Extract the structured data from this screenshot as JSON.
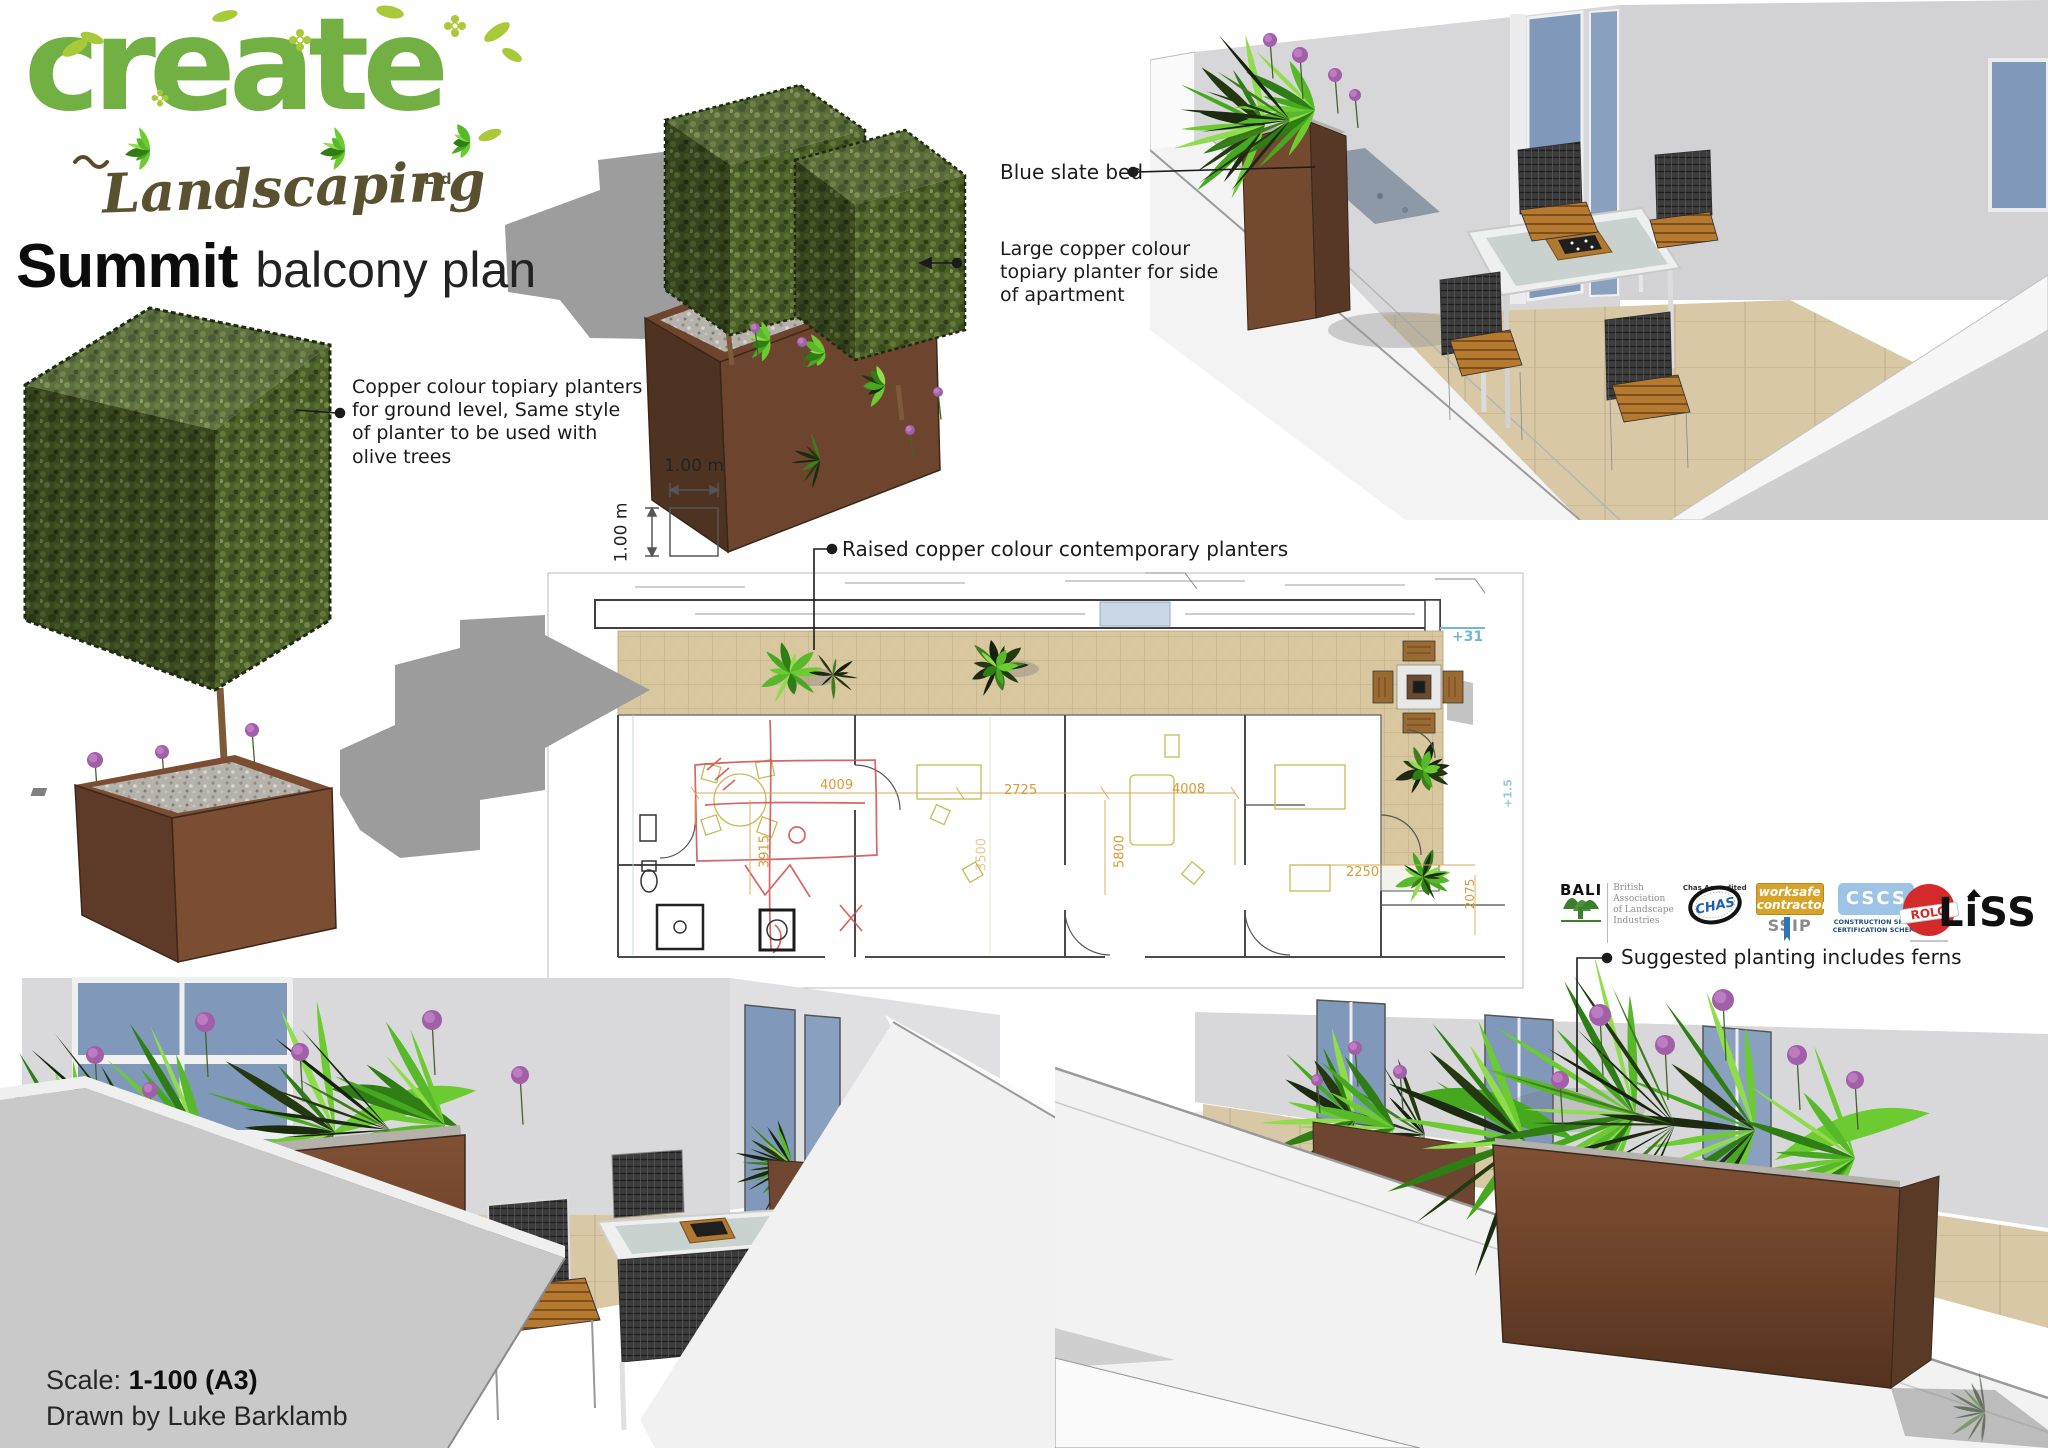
{
  "brand": {
    "name": "create",
    "type": "Landscaping",
    "suffix": "Ltd"
  },
  "title": {
    "main": "Summit",
    "sub": "balcony plan"
  },
  "annotations": {
    "ground_planters": "Copper colour topiary planters\nfor ground level, Same style\nof planter to be used with\nolive trees",
    "large_planter": "Large copper colour\ntopiary planter for side\nof apartment",
    "blue_slate": "Blue slate bed",
    "raised_planters": "Raised copper colour contemporary planters",
    "suggested_planting": "Suggested planting includes ferns"
  },
  "scale_square": {
    "width_label": "1.00 m",
    "height_label": "1.00 m"
  },
  "plan": {
    "level_top": "+31",
    "level_side": "+1.5",
    "dim_a": "4009",
    "dim_b": "2725",
    "dim_c": "4008",
    "dim_d": "3915",
    "dim_e": "3500",
    "dim_f": "5800",
    "dim_g": "2250",
    "dim_h": "2075"
  },
  "footer": {
    "scale_label": "Scale:",
    "scale_value": "1-100 (A3)",
    "drawn_by": "Drawn by Luke Barklamb"
  },
  "logos": {
    "bali_name": "BALI",
    "bali_text": "British\nAssociation\nof Landscape\nIndustries",
    "chas_name": "CHAS",
    "chas_sub": "Chas Accredited",
    "worksafe_line1": "worksafe",
    "worksafe_line2": "contractor",
    "ssip": "SSIP",
    "cscs_name": "CSCS",
    "cscs_sub": "CONSTRUCTION SKILLS\nCERTIFICATION SCHEME",
    "rolo_name": "ROLO",
    "liss_name": "LiSS"
  },
  "colors": {
    "logo_green": "#72b043",
    "leaf_green": "#a9c938",
    "brand_brown": "#59512f",
    "copper": "#7a4b31",
    "foliage_green": "#6ccb31",
    "allium_purple": "#a05fa8",
    "tile_tan": "#d8c7a2",
    "glass_blue": "#8099bb",
    "cscs_blue": "#9dc3e6",
    "worksafe_gold": "#d7a429",
    "rolo_red": "#d42a2a",
    "dim_orange": "#d79a35",
    "level_blue": "#74b6d6",
    "shadow_grey": "#9c9c9c"
  }
}
